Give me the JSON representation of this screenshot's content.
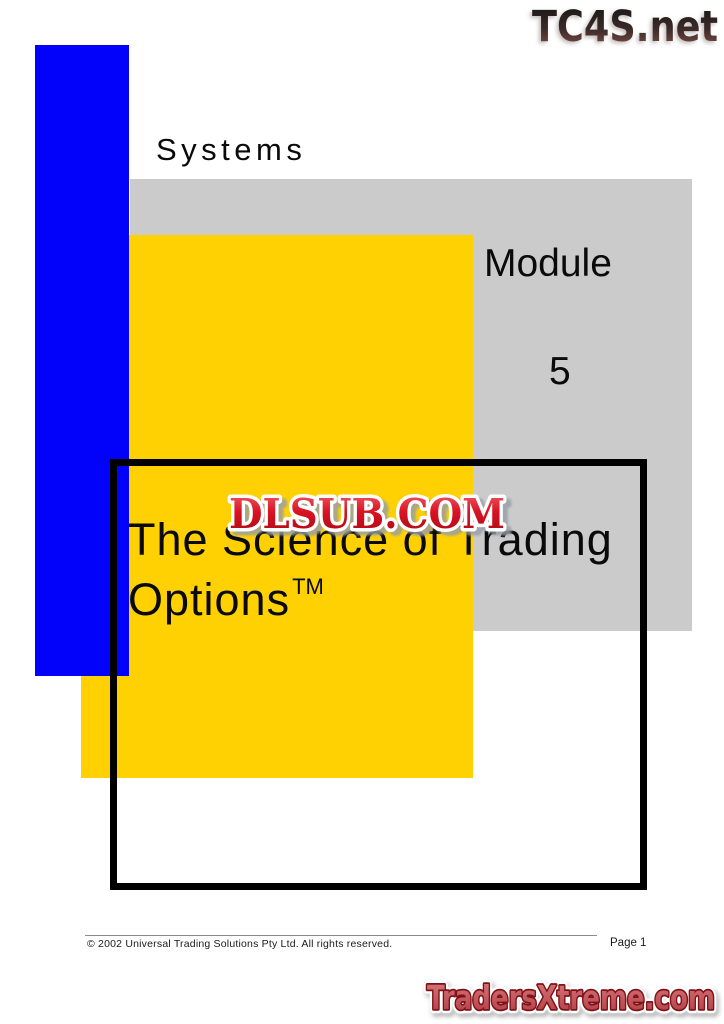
{
  "cover": {
    "eyebrow": "Systems",
    "module_label": "Module",
    "module_number": "5",
    "title_line1": "The Science of Trading",
    "title_line2": "Options",
    "trademark": "TM"
  },
  "logos": {
    "tc4s": "TC4S.net",
    "dlsub": "DLSUB.COM",
    "tradersxtreme": "TradersXtreme.com"
  },
  "footer": {
    "copyright": "© 2002 Universal Trading Solutions Pty Ltd. All rights reserved.",
    "page_number": "Page 1"
  },
  "colors": {
    "accent_blue": "#0202fa",
    "accent_yellow": "#ffd103",
    "accent_gray": "#cbcbcb",
    "frame_black": "#000000",
    "dlsub_red": "#d91423",
    "tradersxtreme_red": "#c4555b",
    "tc4s_dark": "#2b1d1b"
  }
}
